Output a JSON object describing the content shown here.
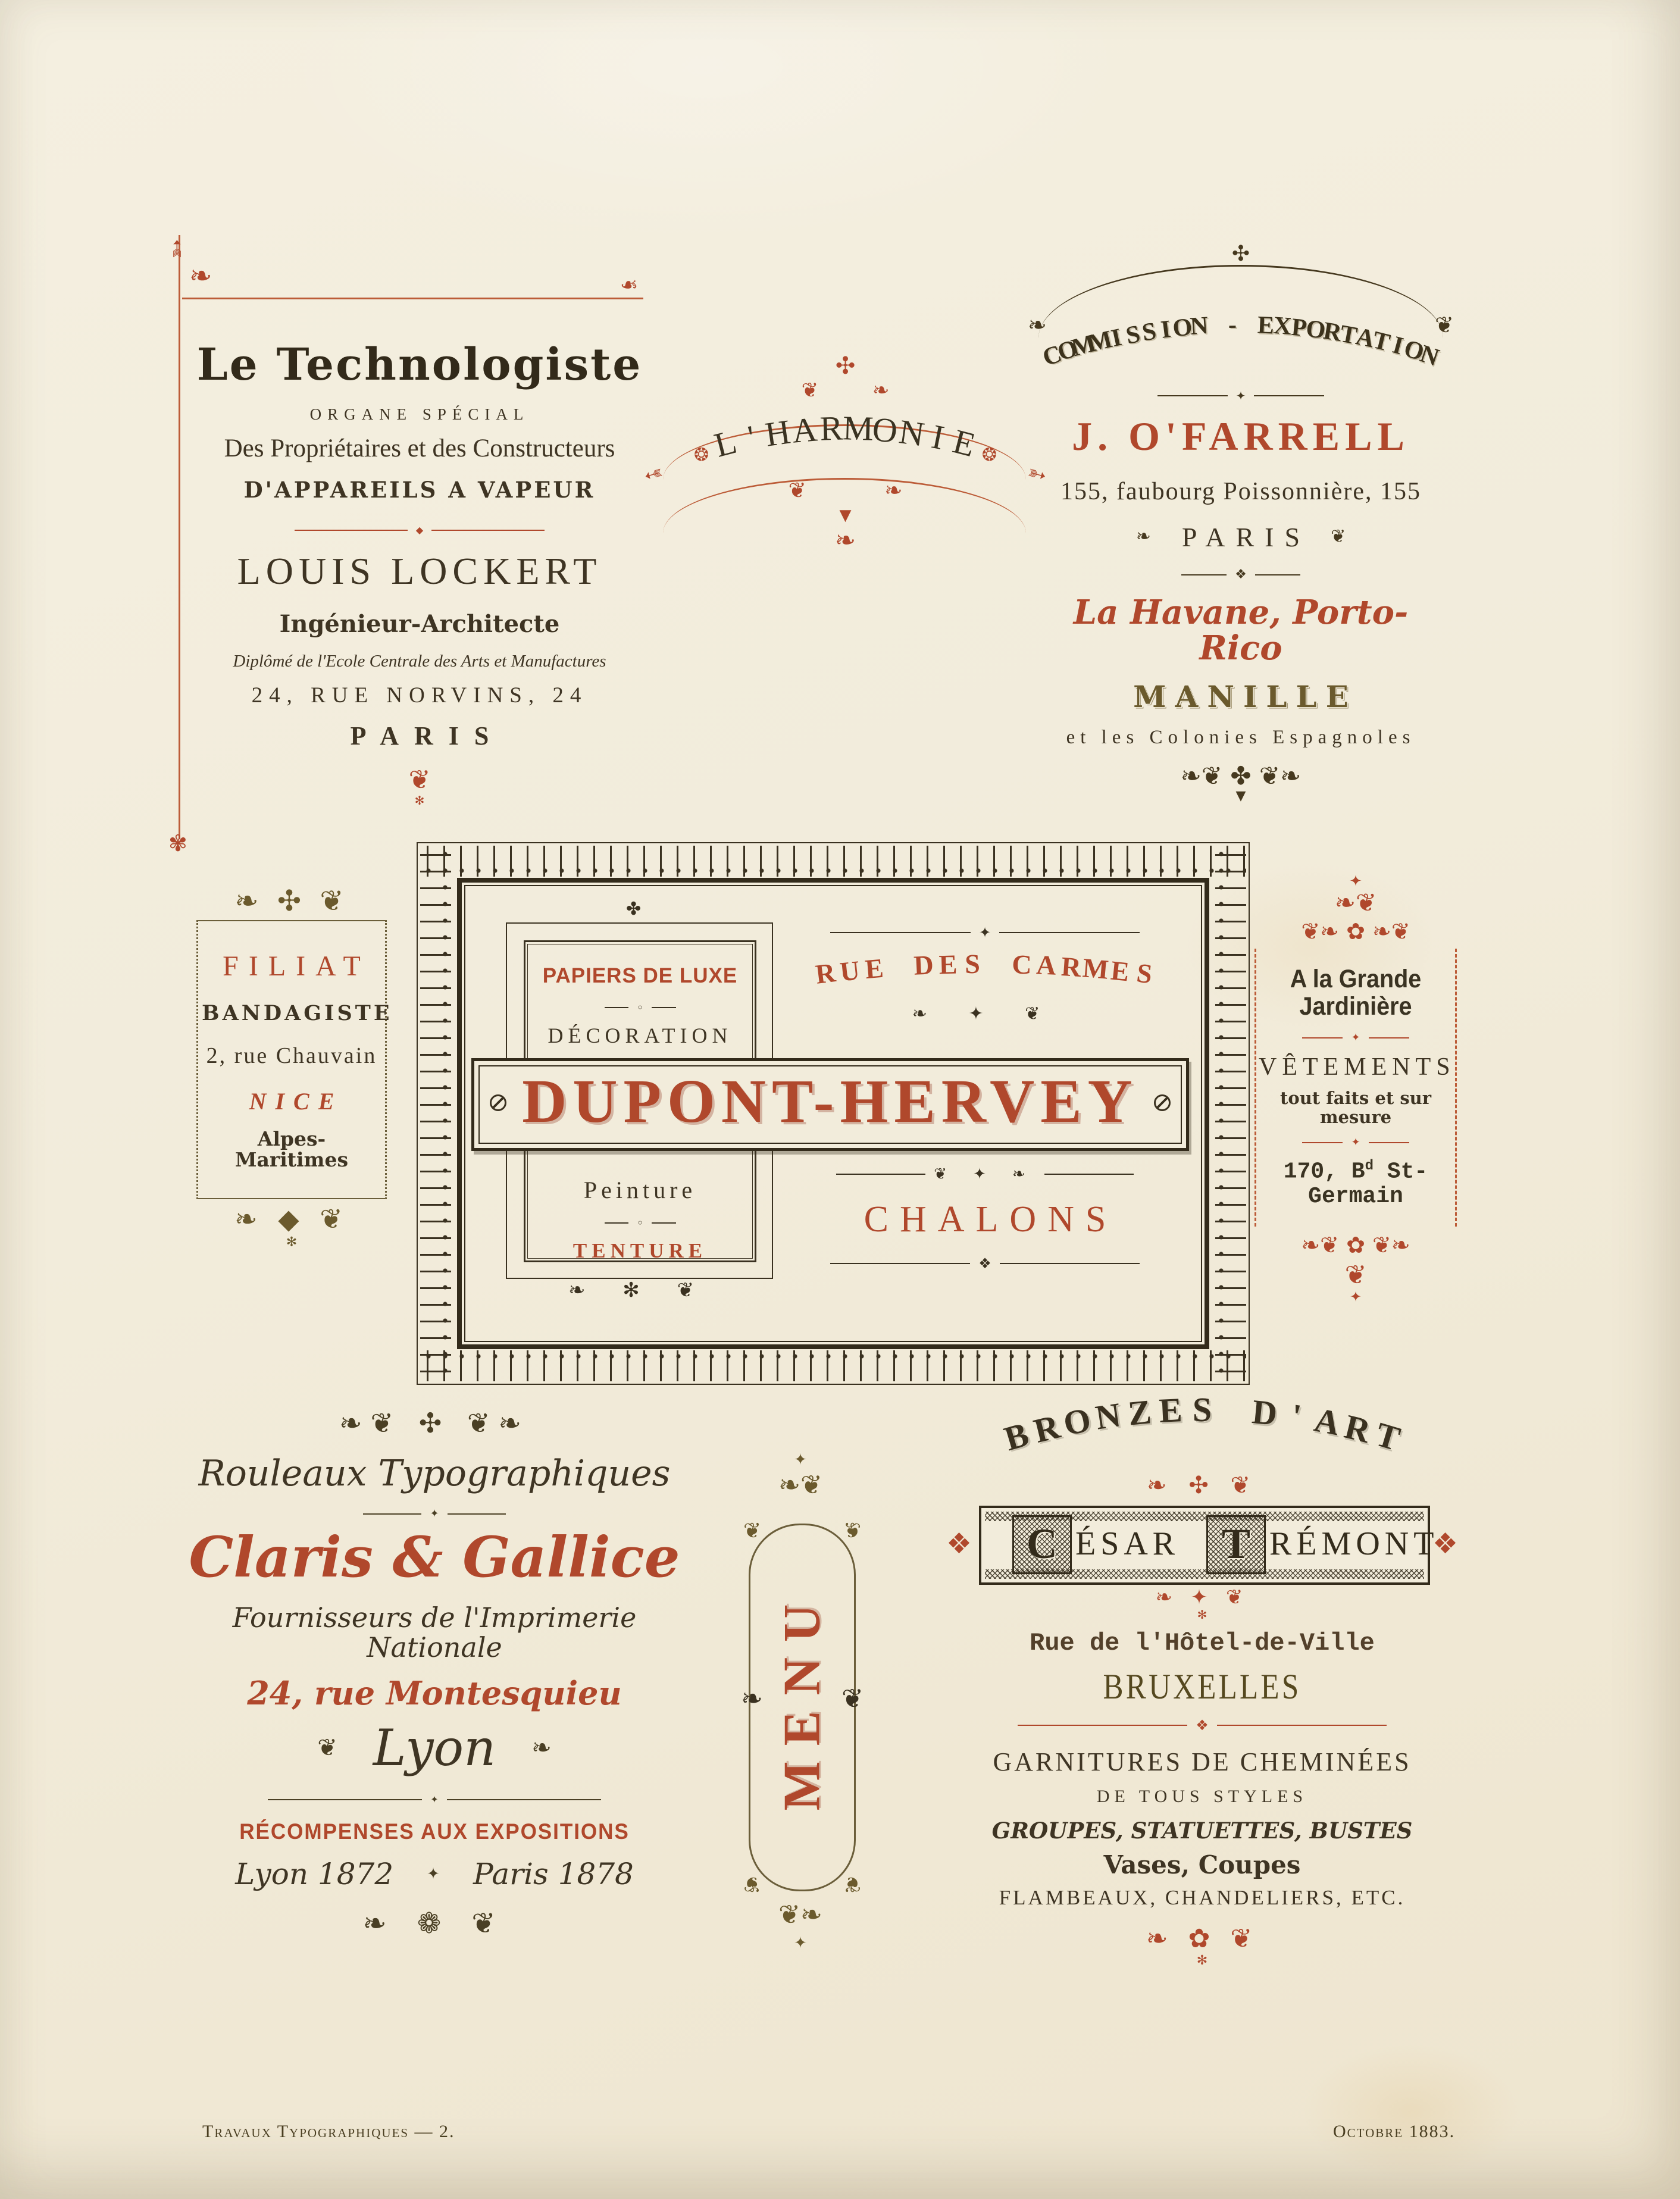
{
  "colors": {
    "paper": "#f2ecdb",
    "ink": "#3e3423",
    "red": "#b0482c",
    "olive": "#6b5a2d"
  },
  "footer": {
    "left": "Travaux Typographiques — 2.",
    "right": "Octobre 1883."
  },
  "blocks": {
    "technologiste": {
      "title": "Le Technologiste",
      "subtitle": "ORGANE SPÉCIAL",
      "line1": "Des Propriétaires et des Constructeurs",
      "line2": "D'APPAREILS A VAPEUR",
      "name": "Louis Lockert",
      "role": "Ingénieur-Architecte",
      "credential": "Diplômé de l'Ecole Centrale des Arts et Manufactures",
      "address": "24, Rue Norvins, 24",
      "city": "PARIS",
      "orn_divider": "◆",
      "orn_bottom": "❦",
      "orn_tip": "✻"
    },
    "harmonie": {
      "title": "L'HARMONIE",
      "orn_top": "✣",
      "orn_band": "❦ ❧",
      "orn_rosette": "❂",
      "orn_arrow": "➳",
      "orn_scrolls": "❦ ❧",
      "orn_pendant": "▼",
      "orn_tail": "❧"
    },
    "ofarrell": {
      "header": "COMMISSION - EXPORTATION",
      "name": "J. O'FARRELL",
      "address": "155, faubourg Poissonnière, 155",
      "city": "PARIS",
      "line1": "La Havane, Porto-Rico",
      "line2": "MANILLE",
      "line3": "et les Colonies Espagnoles",
      "orn_apex": "✣",
      "orn_arc_l": "❧",
      "orn_arc_r": "❦",
      "orn_rule1": "✦",
      "orn_city_l": "❧",
      "orn_city_r": "❦",
      "orn_rule2": "❖",
      "orn_bottom": "❧❦ ✤ ❦❧",
      "orn_tip": "▼"
    },
    "filiat": {
      "name": "FILIAT",
      "role": "BANDAGISTE",
      "address": "2, rue Chauvain",
      "city": "NICE",
      "region": "Alpes-Maritimes",
      "orn_top": "❧ ✣ ❦",
      "orn_bottom": "❧ ◆ ❦",
      "orn_tip": "✻"
    },
    "dupont": {
      "panel_line1": "PAPIERS DE LUXE",
      "panel_line2": "DÉCORATION",
      "panel_line3": "Peinture",
      "panel_line4": "TENTURE",
      "street": "RUE DES CARMES",
      "name": "DUPONT-HERVEY",
      "city": "CHALONS",
      "orn_ring": "◦",
      "orn_panel_top": "✤",
      "orn_panel_bottom": "❧ ✻ ❦",
      "orn_street_top": "✦",
      "orn_street_bottom": "❧ ✦ ❦",
      "orn_city_top": "❦ ✦ ❧",
      "orn_city_bottom": "❖"
    },
    "jardiniere": {
      "name": "A la Grande Jardinière",
      "line1": "VÊTEMENTS",
      "line2": "tout faits et sur mesure",
      "addr_pre": "170, B",
      "addr_sup": "d",
      "addr_post": " St-Germain",
      "orn_finial_star": "✦",
      "orn_finial": "❧❦",
      "orn_band_top": "❦❧ ✿ ❧❦",
      "orn_rule": "✦",
      "orn_band_bottom": "❧❦ ✿ ❦❧",
      "orn_tip": "❦"
    },
    "claris": {
      "header": "Rouleaux Typographiques",
      "name": "Claris & Gallice",
      "line1": "Fournisseurs de l'Imprimerie Nationale",
      "address": "24, rue Montesquieu",
      "city": "Lyon",
      "awards": "RÉCOMPENSES AUX EXPOSITIONS",
      "award1": "Lyon 1872",
      "award2": "Paris 1878",
      "orn_top": "❧❦ ✣ ❦❧",
      "orn_rule": "✦",
      "orn_city_l": "❦",
      "orn_city_r": "❧",
      "orn_award_mid": "✦",
      "orn_bottom": "❧ ❁ ❦"
    },
    "menu": {
      "title": "MENU",
      "orn_finial_top": "✦",
      "orn_finial": "❧❦",
      "orn_corner": "❦",
      "orn_leaf_l": "❧",
      "orn_leaf_r": "❦",
      "orn_finial_bottom": "❦❧",
      "orn_tip": "✦"
    },
    "bronzes": {
      "header": "BRONZES D'ART",
      "initial1": "C",
      "rest1": "ÉSAR",
      "initial2": "T",
      "rest2": "RÉMONT",
      "street": "Rue de l'Hôtel-de-Ville",
      "city": "BRUXELLES",
      "line1": "GARNITURES DE CHEMINÉES",
      "line2": "DE TOUS STYLES",
      "line3": "GROUPES, STATUETTES, BUSTES",
      "line4": "Vases, Coupes",
      "line5": "FLAMBEAUX, CHANDELIERS, ETC.",
      "orn_crest": "❧ ✣ ❦",
      "orn_side_l": "❖",
      "orn_side_r": "❖",
      "orn_pendant": "❧ ✦ ❦",
      "orn_pendant_tip": "✻",
      "orn_rule": "❖",
      "orn_bottom": "❧ ✿ ❦",
      "orn_bottom_tip": "✻"
    },
    "corner": {
      "orn_arrow": "➳",
      "orn_scroll": "❧",
      "orn_end": "❧",
      "orn_pendant": "✾"
    }
  }
}
